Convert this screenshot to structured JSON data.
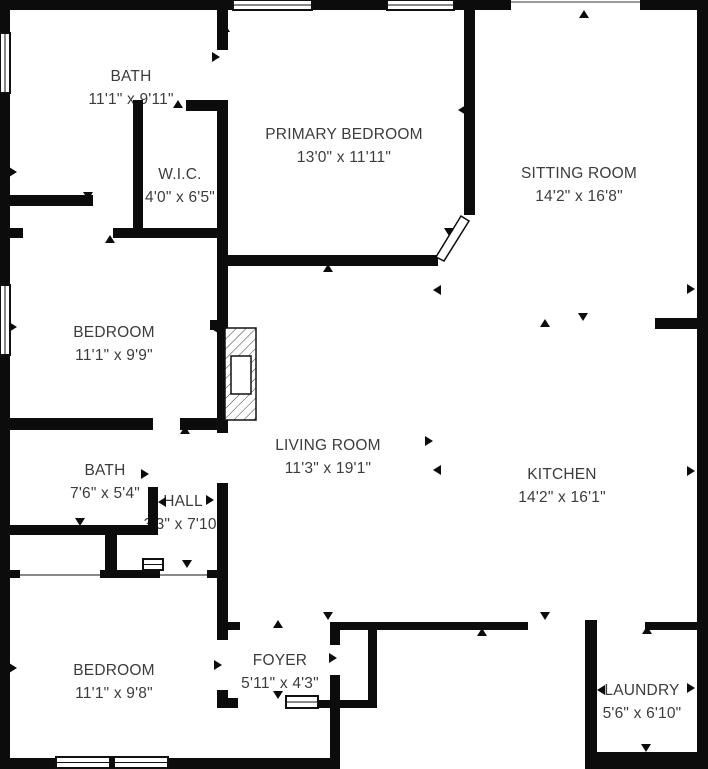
{
  "plan": {
    "type": "floorplan",
    "background_color": "#ffffff",
    "wall_color": "#0c0c0c",
    "text_color": "#3c3c3c",
    "rooms": [
      {
        "id": "bath-primary",
        "name": "BATH",
        "dims": "11'1\" x 9'11\"",
        "cx": 131,
        "cy": 88
      },
      {
        "id": "wic",
        "name": "W.I.C.",
        "dims": "4'0\" x 6'5\"",
        "cx": 180,
        "cy": 186
      },
      {
        "id": "primary-bedroom",
        "name": "PRIMARY BEDROOM",
        "dims": "13'0\" x 11'11\"",
        "cx": 344,
        "cy": 146
      },
      {
        "id": "sitting-room",
        "name": "SITTING ROOM",
        "dims": "14'2\" x 16'8\"",
        "cx": 579,
        "cy": 185
      },
      {
        "id": "bedroom-middle",
        "name": "BEDROOM",
        "dims": "11'1\" x 9'9\"",
        "cx": 114,
        "cy": 344
      },
      {
        "id": "living-room",
        "name": "LIVING ROOM",
        "dims": "11'3\" x 19'1\"",
        "cx": 328,
        "cy": 457
      },
      {
        "id": "bath-hall",
        "name": "BATH",
        "dims": "7'6\" x 5'4\"",
        "cx": 105,
        "cy": 482
      },
      {
        "id": "hall",
        "name": "HALL",
        "dims": "3'3\" x 7'10\"",
        "cx": 183,
        "cy": 513
      },
      {
        "id": "kitchen",
        "name": "KITCHEN",
        "dims": "14'2\" x 16'1\"",
        "cx": 562,
        "cy": 486
      },
      {
        "id": "bedroom-bottom",
        "name": "BEDROOM",
        "dims": "11'1\" x 9'8\"",
        "cx": 114,
        "cy": 682
      },
      {
        "id": "foyer",
        "name": "FOYER",
        "dims": "5'11\" x 4'3\"",
        "cx": 280,
        "cy": 672
      },
      {
        "id": "laundry",
        "name": "LAUNDRY",
        "dims": "5'6\" x 6'10\"",
        "cx": 642,
        "cy": 702
      }
    ],
    "features": [
      "fireplace",
      "front-door",
      "window-icons",
      "door-swing-markers",
      "angled-doorway"
    ]
  }
}
